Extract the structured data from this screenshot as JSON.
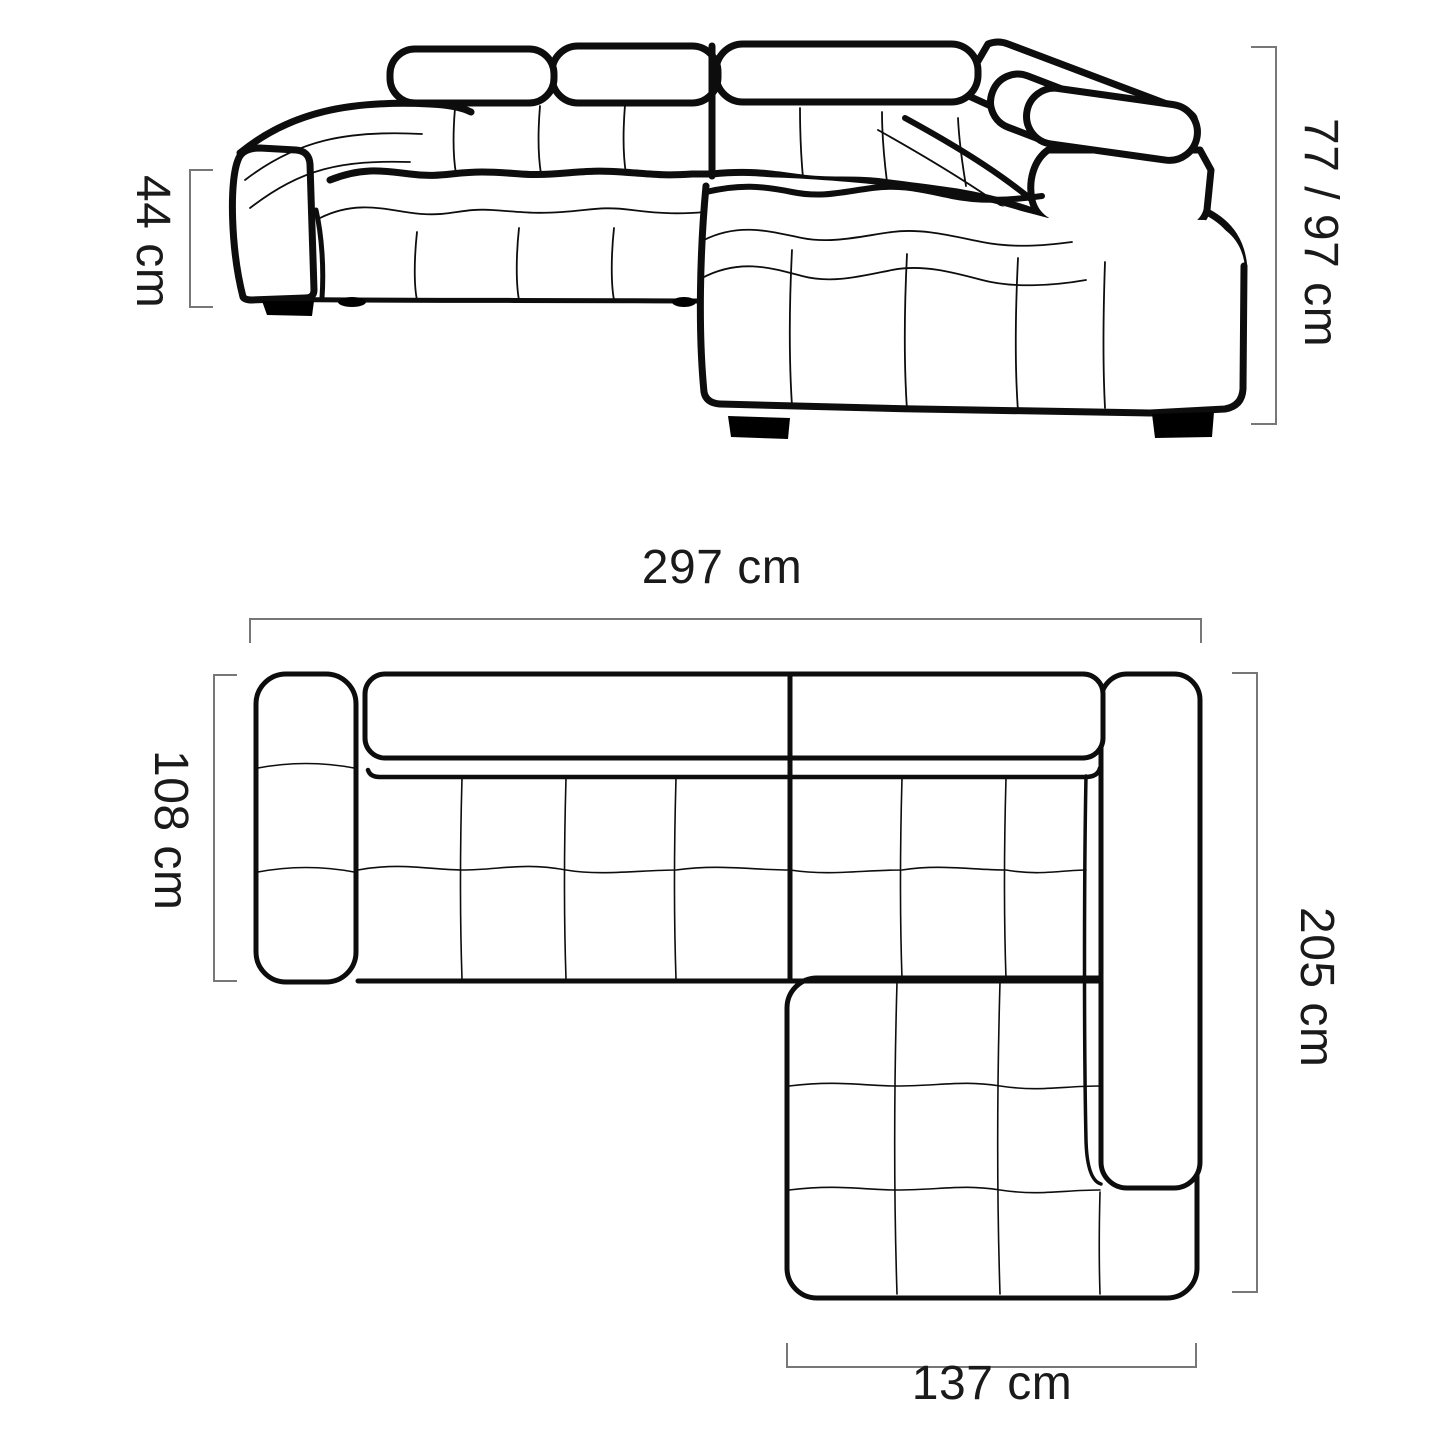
{
  "title": "Corner sofa with chaise — dimension diagram",
  "unit": "cm",
  "colors": {
    "background": "#ffffff",
    "outline": "#0d0d0d",
    "dimension_lines": "#777777",
    "text": "#1a1a1a",
    "feet": "#000000"
  },
  "views": {
    "front": {
      "name": "front perspective view",
      "parts": [
        "left-armrest",
        "headrest-cushions",
        "tufted-backrest",
        "tufted-seat",
        "corner-section",
        "right-armrest-with-headrest",
        "chaise-longue",
        "black-feet"
      ]
    },
    "plan": {
      "name": "top plan view",
      "parts": [
        "left-armrest",
        "backrest-band",
        "seat-cushions",
        "right-armrest",
        "chaise-longue"
      ]
    }
  },
  "dimensions": {
    "seat_height": {
      "label": "44 cm",
      "value": 44,
      "view": "front",
      "side": "left",
      "meaning": "seat height"
    },
    "total_height": {
      "label": "77 / 97 cm",
      "value_min": 77,
      "value_max": 97,
      "view": "front",
      "side": "right",
      "meaning": "backrest height with headrest down / up"
    },
    "total_width": {
      "label": "297 cm",
      "value": 297,
      "view": "plan",
      "side": "top",
      "meaning": "overall width"
    },
    "main_depth": {
      "label": "108 cm",
      "value": 108,
      "view": "plan",
      "side": "left",
      "meaning": "sofa depth"
    },
    "total_depth": {
      "label": "205 cm",
      "value": 205,
      "view": "plan",
      "side": "right",
      "meaning": "overall depth with chaise"
    },
    "chaise_width": {
      "label": "137 cm",
      "value": 137,
      "view": "plan",
      "side": "bottom",
      "meaning": "chaise width"
    }
  }
}
